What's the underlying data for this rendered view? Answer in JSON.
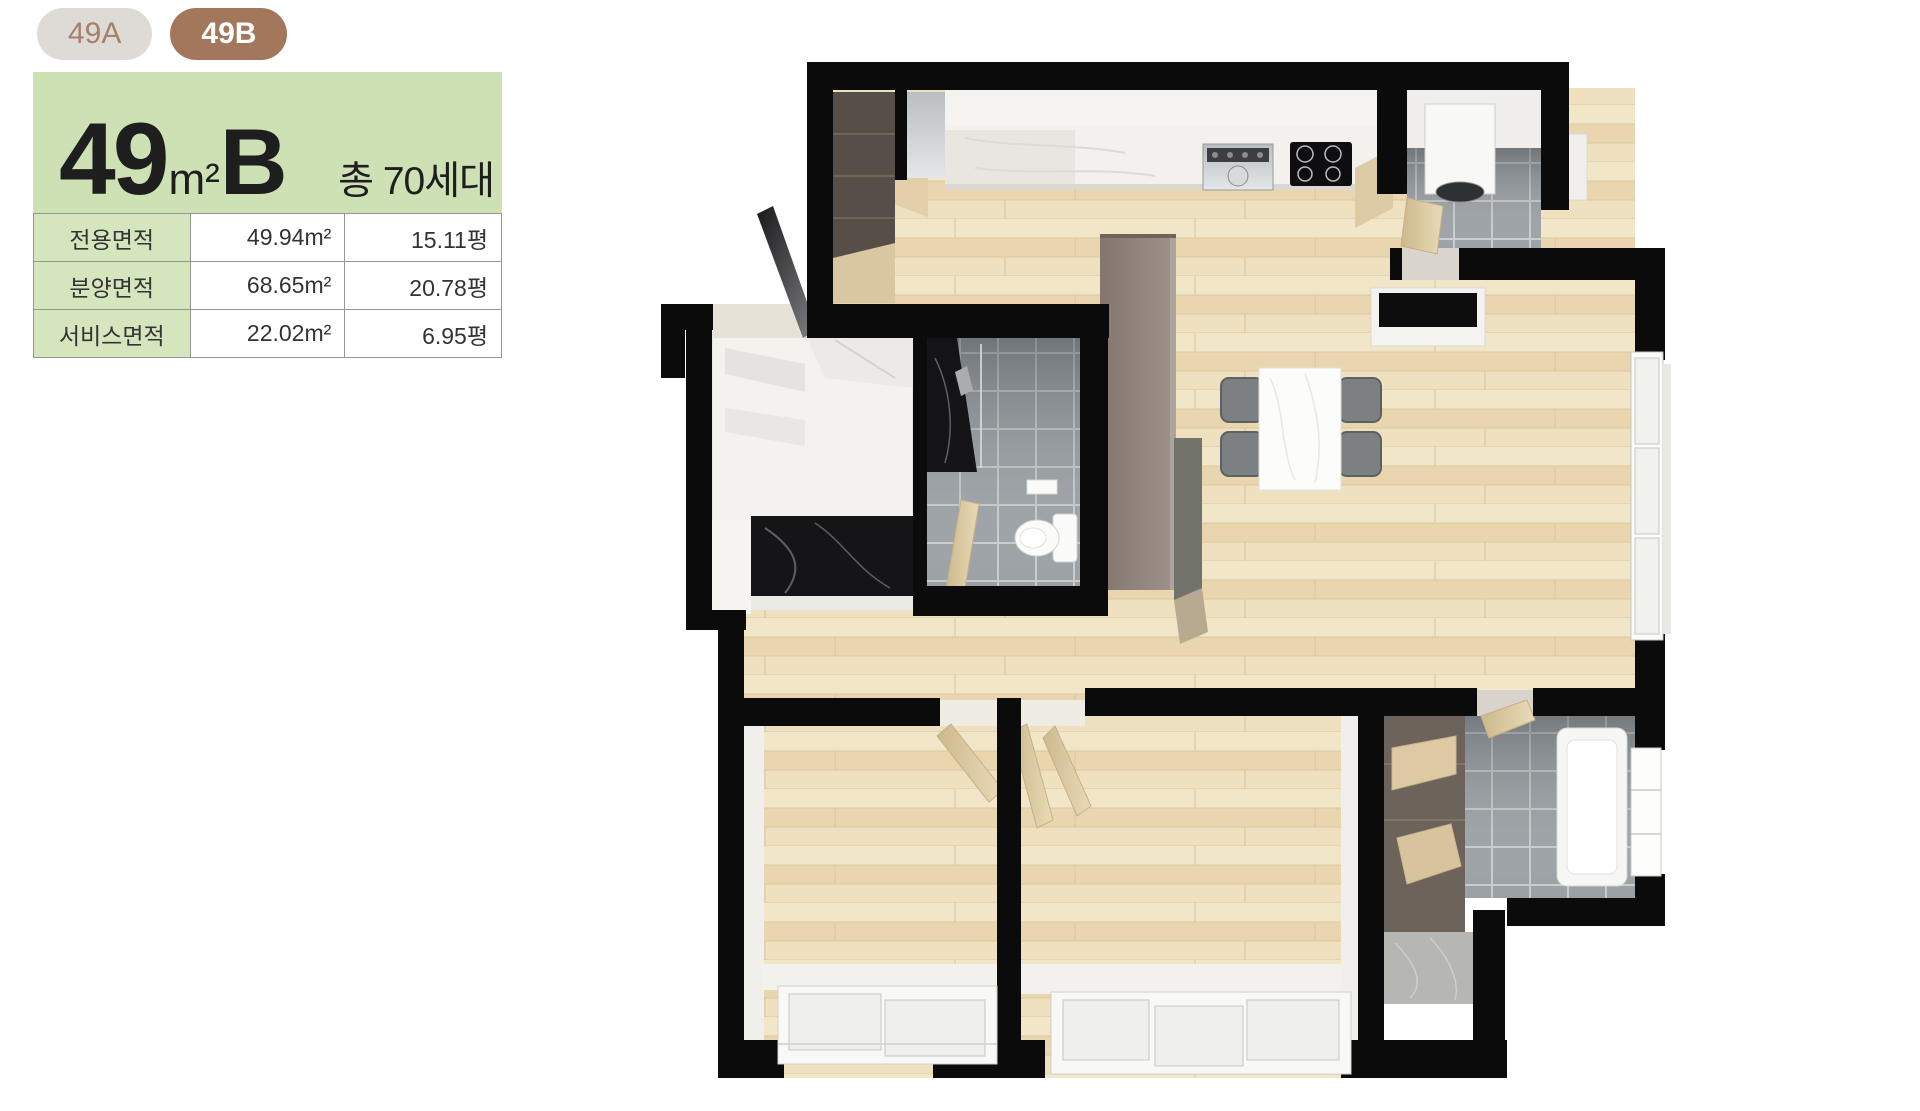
{
  "tabs": [
    {
      "label": "49A",
      "active": false
    },
    {
      "label": "49B",
      "active": true
    }
  ],
  "unit_header": {
    "area_number": "49",
    "area_unit": "m²",
    "type_letter": "B",
    "total_households": "총 70세대"
  },
  "area_table": {
    "rows": [
      {
        "label": "전용면적",
        "sqm": "49.94m²",
        "pyeong": "15.11평"
      },
      {
        "label": "분양면적",
        "sqm": "68.65m²",
        "pyeong": "20.78평"
      },
      {
        "label": "서비스면적",
        "sqm": "22.02m²",
        "pyeong": "6.95평"
      }
    ]
  },
  "colors": {
    "tab_active_bg": "#a2775b",
    "tab_inactive_bg": "#dedbd6",
    "tab_inactive_text": "#a5806a",
    "panel_green": "#cde1b5",
    "cell_green": "#d5e6bf",
    "wall_black": "#0b0b0b",
    "floor_wood": "#ecdcba",
    "tile_gray": "#999fa3"
  }
}
